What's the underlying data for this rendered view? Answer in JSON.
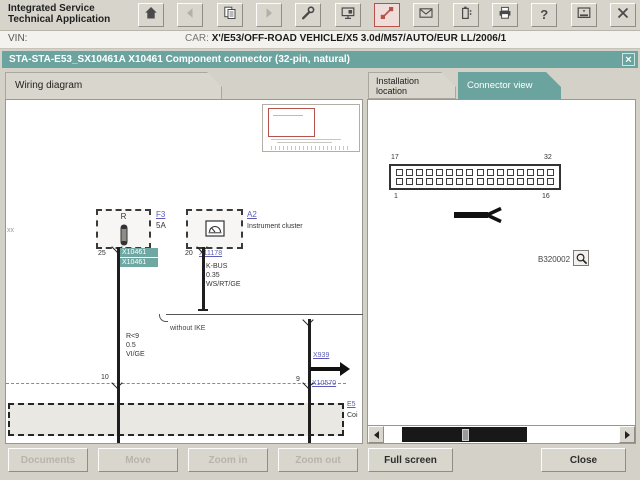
{
  "app_title_lines": [
    "Integrated Service",
    "Technical Application"
  ],
  "toolbar": {
    "icons": [
      {
        "name": "home",
        "enabled": true,
        "active": false
      },
      {
        "name": "back-arrow",
        "enabled": false,
        "active": false
      },
      {
        "name": "document",
        "enabled": true,
        "active": false
      },
      {
        "name": "forward-arrow",
        "enabled": false,
        "active": false
      },
      {
        "name": "wrench",
        "enabled": true,
        "active": false
      },
      {
        "name": "monitor",
        "enabled": true,
        "active": false
      },
      {
        "name": "plug",
        "enabled": true,
        "active": true
      },
      {
        "name": "envelope",
        "enabled": true,
        "active": false
      },
      {
        "name": "battery",
        "enabled": true,
        "active": false
      },
      {
        "name": "printer",
        "enabled": true,
        "active": false
      },
      {
        "name": "question",
        "enabled": true,
        "active": false
      },
      {
        "name": "screen",
        "enabled": true,
        "active": false
      },
      {
        "name": "close",
        "enabled": true,
        "active": false
      }
    ]
  },
  "vehicle_bar": {
    "vin_label": "VIN:",
    "car_label": "CAR:",
    "car_value": "X'/E53/OFF-ROAD VEHICLE/X5 3.0d/M57/AUTO/EUR LL/2006/1"
  },
  "doc_bar": {
    "title": "STA-STA-E53_SX10461A X10461 Component connector (32-pin, natural)",
    "close_glyph": "×"
  },
  "tabs": {
    "wiring_diagram": "Wiring diagram",
    "installation_location": [
      "Installation",
      "location"
    ],
    "connector_view": "Connector view"
  },
  "diagram": {
    "edge_fragment": "xx",
    "fuse": {
      "terminal": "R",
      "link": "F3",
      "rating": "5A",
      "pin": "25",
      "tag1": "X10461",
      "tag2": "X10461"
    },
    "left_wire": {
      "l1": "R<9",
      "l2": "0.5",
      "l3": "VI/GE",
      "pin": "10"
    },
    "cluster": {
      "link": "A2",
      "label": "Instrument cluster",
      "pin": "20",
      "connector_link": "X11178"
    },
    "bus_wire": {
      "l1": "K-BUS",
      "l2": "0.35",
      "l3": "WS/RT/GE"
    },
    "branch_label": "without IKE",
    "branch": {
      "arrow_link": "X939",
      "pin": "9",
      "connector_link": "X10570"
    },
    "bottom_box": {
      "link": "E5",
      "label": "Coi"
    }
  },
  "connector_view": {
    "pin_rows": 2,
    "pin_cols": 16,
    "labels": {
      "top_left": "17",
      "top_right": "32",
      "bottom_left": "1",
      "bottom_right": "16"
    },
    "figure_id": "B320002"
  },
  "footer_buttons": {
    "documents": "Documents",
    "move": "Move",
    "zoom_in": "Zoom in",
    "zoom_out": "Zoom out",
    "full_screen": "Full screen",
    "close": "Close"
  },
  "colors": {
    "teal": "#6ba39e",
    "link": "#5c5cb8",
    "red": "#b5524c"
  }
}
